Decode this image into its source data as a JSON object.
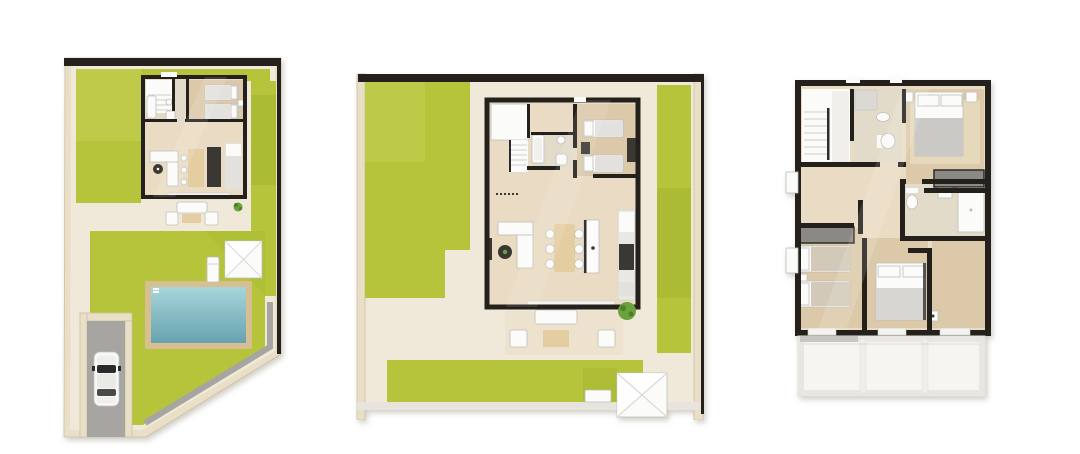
{
  "scene": {
    "description": "Three 3D top-down architectural floor-plan renders of a villa on a white background",
    "background": "#ffffff"
  },
  "colors": {
    "wall": "#24211d",
    "ground": "#f0e9d9",
    "boundary": "#e9dec6",
    "boundaryEdge": "#cdc1a4",
    "grass": "#b5c43a",
    "grassLight": "#c4d053",
    "grassShade": "#a2b22e",
    "floorWood": "#eadcc4",
    "floorTan": "#dcc9a9",
    "tile": "#e2dbc9",
    "white": "#fbfbfa",
    "grayLight": "#e2e1dd",
    "gray": "#bfbeba",
    "dark": "#3b3834",
    "tableWood": "#e5cda2",
    "poolDeck": "#d8bf92",
    "poolLight": "#a7d6da",
    "poolDeep": "#68a2b0",
    "path": "#a6a5a1",
    "glass": "#2b2b2b",
    "plant": "#6ba23b",
    "plantDark": "#4f7f2a",
    "balcony": "#f6f5f2",
    "balconyEdge": "#deddd8",
    "rug": "#e9dcc2"
  },
  "plans": [
    {
      "id": "plot-plan",
      "name": "Villa plot plan with garden, swimming pool, driveway and ground floor",
      "objects": [
        "garden-lawn",
        "swimming-pool",
        "pool-deck",
        "parked-car",
        "driveway",
        "terrace-lounge-set",
        "parasol",
        "sun-lounger",
        "shrub",
        "ground-floor",
        "twin-bedroom",
        "bathroom",
        "staircase",
        "corner-sofa",
        "dining-table",
        "kitchen-counter"
      ]
    },
    {
      "id": "ground-floor-plan",
      "name": "Ground floor plan with living-dining-kitchen, twin bedroom, bathroom and garden terrace",
      "objects": [
        "garden-lawn",
        "staircase",
        "bathtub",
        "twin-bedroom",
        "corner-sofa",
        "coffee-table",
        "dining-table-six-chairs",
        "kitchen-island",
        "kitchen-counter",
        "terrace-lounge-set",
        "potted-plant",
        "parasol",
        "sun-lounger"
      ]
    },
    {
      "id": "first-floor-plan",
      "name": "First floor plan with three bedrooms, two bathrooms and balcony",
      "objects": [
        "staircase",
        "bathroom-shower",
        "master-bedroom-double-bed",
        "wardrobe",
        "second-bathroom",
        "twin-bedroom",
        "double-bedroom",
        "balcony-pergola"
      ]
    }
  ]
}
